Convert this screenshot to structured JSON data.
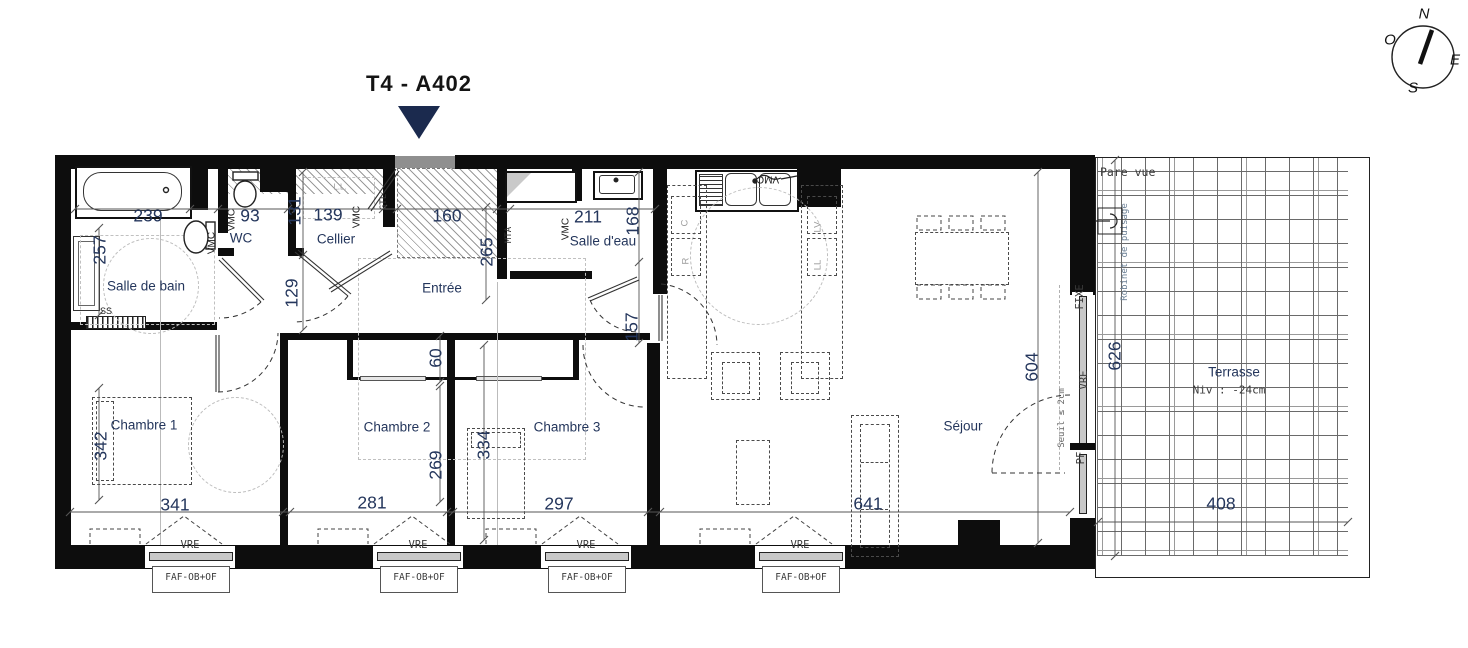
{
  "title": "T4 - A402",
  "compass": {
    "n": "N",
    "w": "O",
    "e": "E",
    "s": "S"
  },
  "rooms": {
    "salle_de_bain": "Salle de bain",
    "wc": "WC",
    "cellier": "Cellier",
    "entree": "Entrée",
    "salle_deau": "Salle d'eau",
    "chambre1": "Chambre 1",
    "chambre2": "Chambre 2",
    "chambre3": "Chambre 3",
    "sejour": "Séjour",
    "terrasse": "Terrasse"
  },
  "terrasse_info": {
    "niveau": "Niv : -24cm",
    "pare_vue": "Pare vue",
    "robinet": "Robinet de puisage"
  },
  "dims": {
    "sdb_largeur": "239",
    "wc_largeur": "93",
    "wc_hauteur": "131",
    "cellier_largeur": "139",
    "entree_largeur": "160",
    "salle_deau_largeur": "211",
    "salle_deau_hauteur": "168",
    "sdb_hauteur": "257",
    "degagement": "129",
    "entree_hauteur": "265",
    "placard": "60",
    "cuisine": "157",
    "chambre1_hauteur": "342",
    "chambre2_hauteur": "269",
    "chambre3_hauteur": "334",
    "sejour_hauteur": "604",
    "terrasse_hauteur": "626",
    "chambre1_largeur": "341",
    "chambre2_largeur": "281",
    "chambre3_largeur": "297",
    "sejour_largeur": "641",
    "terrasse_largeur": "408"
  },
  "annotations": {
    "vmc": "VMC",
    "gtl": "GTL",
    "mta": "MTA",
    "ss": "SS",
    "lave_linge": "L.L.",
    "cuisiniere": "C",
    "refrigerateur": "R",
    "lave_vaisselle": "LV",
    "lave_linge2": "LL",
    "vre": "VRE",
    "faf": "FAF-OB+OF",
    "fixe": "FIXE",
    "pf": "PF",
    "seuil": "Seuil ≤ 2cm"
  },
  "colors": {
    "accent": "#1b2a4e",
    "dim_text": "#24365c",
    "wall": "#0d0d0d"
  }
}
